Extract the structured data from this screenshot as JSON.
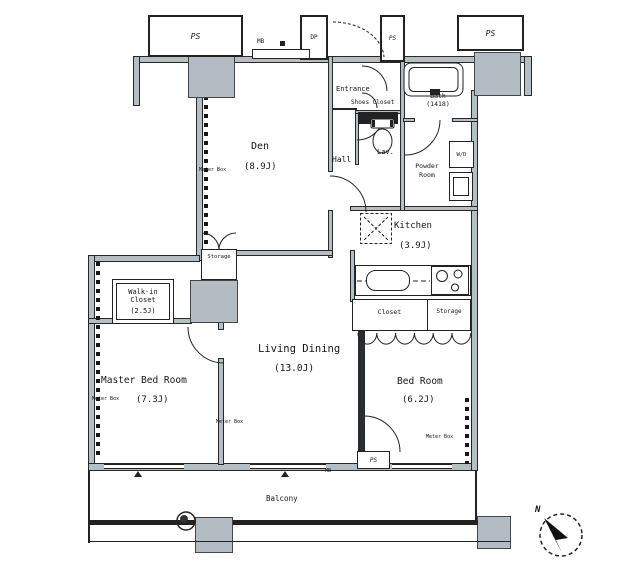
{
  "rooms": {
    "den": {
      "name": "Den",
      "size": "(8.9J)"
    },
    "entrance": {
      "name": "Entrance"
    },
    "shoes_closet": {
      "name": "Shoes Closet"
    },
    "bath": {
      "name": "Bath",
      "size": "(1418)"
    },
    "lav": {
      "name": "Lav."
    },
    "hall": {
      "name": "Hall"
    },
    "powder": {
      "line1": "Powder",
      "line2": "Room"
    },
    "kitchen": {
      "name": "Kitchen",
      "size": "(3.9J)"
    },
    "den_storage": {
      "name": "Storage"
    },
    "closet": {
      "name": "Closet"
    },
    "storage": {
      "name": "Storage"
    },
    "wic": {
      "line1": "Walk-in",
      "line2": "Closet",
      "size": "(2.5J)"
    },
    "master": {
      "name": "Master Bed Room",
      "size": "(7.3J)"
    },
    "living": {
      "name": "Living Dining",
      "size": "(13.0J)"
    },
    "bedroom": {
      "name": "Bed Room",
      "size": "(6.2J)"
    },
    "balcony": {
      "name": "Balcony"
    }
  },
  "labels": {
    "ps": "PS",
    "dp": "DP",
    "mb": "MB",
    "wd": "W/D",
    "meter_box": "Meter Box",
    "north": "N"
  },
  "colors": {
    "wall_gray": "#b5bec3",
    "pillar_gray": "#b2bcc2",
    "line": "#222222"
  }
}
